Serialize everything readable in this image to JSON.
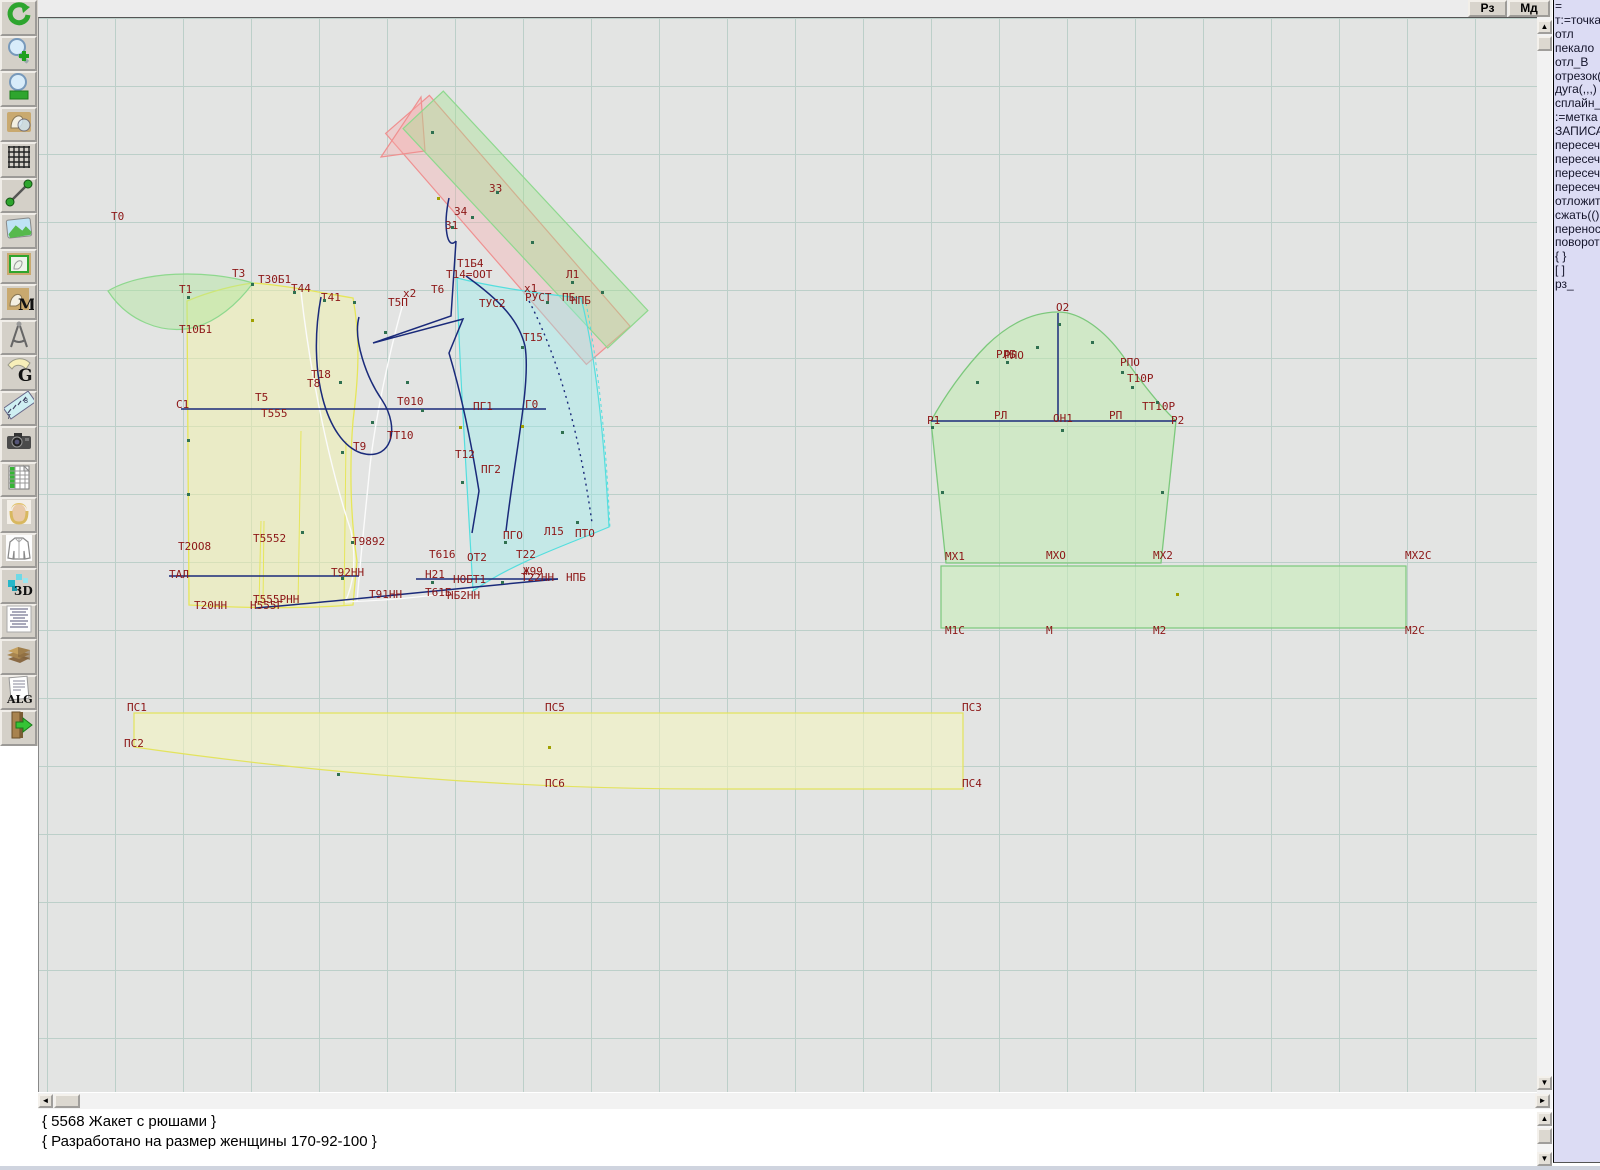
{
  "topbar": {
    "buttons": [
      {
        "label": "Рз"
      },
      {
        "label": "Мд"
      }
    ]
  },
  "toolbar": {
    "items": [
      "refresh",
      "zoom-in",
      "zoom-out",
      "preview-pattern",
      "grid-toggle",
      "segment-tool",
      "image-view",
      "pattern-frame",
      "pattern-marker",
      "compass-tool",
      "grading",
      "ruler-tool",
      "camera-snapshot",
      "size-table",
      "model-photo",
      "garment-view",
      "view-3d",
      "specification",
      "archive",
      "algorithm",
      "exit"
    ]
  },
  "command_panel": {
    "lines": [
      "=",
      "т:=точка",
      "отл",
      "пекало",
      "отл_В",
      "отрезок(",
      "дуга(,,,)",
      "сплайн_",
      ":=метка",
      "ЗАПИСА",
      "пересеч",
      "пересеч",
      "пересеч",
      "пересеч",
      "отложит",
      "сжать(()",
      "перенос",
      "поворот",
      "{ }",
      "[ ]",
      "рз_"
    ]
  },
  "status": {
    "line1": "{ 5568 Жакет с рюшами }",
    "line2": "{ Разработано на размер женщины 170-92-100 }"
  },
  "colors": {
    "canvas_bg": "#e3e4e3",
    "grid_line": "#bccfc9",
    "label": "#8c1616",
    "construction": "#1a2a7a",
    "back_piece": "#e6e65a",
    "front_piece": "#54dede",
    "sleeve_piece": "#7cc87c",
    "strip_green": "#8ed88e",
    "strip_pink": "#ef9090",
    "point_green": "#2f7050",
    "point_olive": "#a0a000",
    "panel_bg": "#dcdcf4"
  },
  "canvas": {
    "labels": [
      {
        "t": "Т0",
        "x": 110,
        "y": 210
      },
      {
        "t": "Т1",
        "x": 178,
        "y": 283
      },
      {
        "t": "Т3",
        "x": 231,
        "y": 267
      },
      {
        "t": "Т30Б1",
        "x": 257,
        "y": 273
      },
      {
        "t": "Т44",
        "x": 290,
        "y": 282
      },
      {
        "t": "Т41",
        "x": 320,
        "y": 291
      },
      {
        "t": "Т10Б1",
        "x": 178,
        "y": 323
      },
      {
        "t": "Т18",
        "x": 310,
        "y": 368
      },
      {
        "t": "Т8",
        "x": 306,
        "y": 377
      },
      {
        "t": "Т5",
        "x": 254,
        "y": 391
      },
      {
        "t": "С1",
        "x": 175,
        "y": 398
      },
      {
        "t": "Т555",
        "x": 260,
        "y": 407
      },
      {
        "t": "Т010",
        "x": 396,
        "y": 395
      },
      {
        "t": "ПГ1",
        "x": 472,
        "y": 400
      },
      {
        "t": "Г0",
        "x": 524,
        "y": 398
      },
      {
        "t": "ТТ10",
        "x": 386,
        "y": 429
      },
      {
        "t": "Т9",
        "x": 352,
        "y": 440
      },
      {
        "t": "Т12",
        "x": 454,
        "y": 448
      },
      {
        "t": "ПГ2",
        "x": 480,
        "y": 463
      },
      {
        "t": "Т15",
        "x": 522,
        "y": 331
      },
      {
        "t": "х2",
        "x": 402,
        "y": 287
      },
      {
        "t": "Т5П",
        "x": 387,
        "y": 296
      },
      {
        "t": "Т6",
        "x": 430,
        "y": 283
      },
      {
        "t": "Т1Б4",
        "x": 456,
        "y": 257
      },
      {
        "t": "Т14=ООТ",
        "x": 445,
        "y": 268
      },
      {
        "t": "х1",
        "x": 523,
        "y": 282
      },
      {
        "t": "Л1",
        "x": 565,
        "y": 268
      },
      {
        "t": "ТУС2",
        "x": 478,
        "y": 297
      },
      {
        "t": "РУСТ",
        "x": 524,
        "y": 291
      },
      {
        "t": "ПБ",
        "x": 561,
        "y": 291
      },
      {
        "t": "НПБ",
        "x": 570,
        "y": 294
      },
      {
        "t": "З3",
        "x": 488,
        "y": 182
      },
      {
        "t": "З4",
        "x": 453,
        "y": 205
      },
      {
        "t": "З1",
        "x": 444,
        "y": 219
      },
      {
        "t": "Т2ОО8",
        "x": 177,
        "y": 540
      },
      {
        "t": "Т5552",
        "x": 252,
        "y": 532
      },
      {
        "t": "Т9892",
        "x": 351,
        "y": 535
      },
      {
        "t": "ТАЛ",
        "x": 168,
        "y": 568
      },
      {
        "t": "Т92НН",
        "x": 330,
        "y": 566
      },
      {
        "t": "Т91НН",
        "x": 368,
        "y": 588
      },
      {
        "t": "Т616",
        "x": 428,
        "y": 548
      },
      {
        "t": "ОТ2",
        "x": 466,
        "y": 551
      },
      {
        "t": "Т22",
        "x": 515,
        "y": 548
      },
      {
        "t": "Н21",
        "x": 424,
        "y": 568
      },
      {
        "t": "НОБТ1",
        "x": 452,
        "y": 573
      },
      {
        "t": "Ж99",
        "x": 522,
        "y": 565
      },
      {
        "t": "Т22НН",
        "x": 520,
        "y": 571
      },
      {
        "t": "НПБ",
        "x": 565,
        "y": 571
      },
      {
        "t": "Т61Б",
        "x": 424,
        "y": 586
      },
      {
        "t": "НБ2НН",
        "x": 446,
        "y": 589
      },
      {
        "t": "Т20НН",
        "x": 193,
        "y": 599
      },
      {
        "t": "Т555РНН",
        "x": 252,
        "y": 593
      },
      {
        "t": "Н555Г",
        "x": 249,
        "y": 599
      },
      {
        "t": "ПГО",
        "x": 502,
        "y": 529
      },
      {
        "t": "Л15",
        "x": 543,
        "y": 525
      },
      {
        "t": "ПТО",
        "x": 574,
        "y": 527
      },
      {
        "t": "О2",
        "x": 1055,
        "y": 301
      },
      {
        "t": "РЛБ",
        "x": 995,
        "y": 348
      },
      {
        "t": "РЛО",
        "x": 1003,
        "y": 349
      },
      {
        "t": "РПО",
        "x": 1119,
        "y": 356
      },
      {
        "t": "Т10Р",
        "x": 1126,
        "y": 372
      },
      {
        "t": "ТТ10Р",
        "x": 1141,
        "y": 400
      },
      {
        "t": "Р1",
        "x": 926,
        "y": 414
      },
      {
        "t": "РЛ",
        "x": 993,
        "y": 409
      },
      {
        "t": "ОН1",
        "x": 1052,
        "y": 412
      },
      {
        "t": "РП",
        "x": 1108,
        "y": 409
      },
      {
        "t": "Р2",
        "x": 1170,
        "y": 414
      },
      {
        "t": "МХ1",
        "x": 944,
        "y": 550
      },
      {
        "t": "МХО",
        "x": 1045,
        "y": 549
      },
      {
        "t": "МХ2",
        "x": 1152,
        "y": 549
      },
      {
        "t": "МХ2С",
        "x": 1404,
        "y": 549
      },
      {
        "t": "М1С",
        "x": 944,
        "y": 624
      },
      {
        "t": "М",
        "x": 1045,
        "y": 624
      },
      {
        "t": "М2",
        "x": 1152,
        "y": 624
      },
      {
        "t": "М2С",
        "x": 1404,
        "y": 624
      },
      {
        "t": "ПС1",
        "x": 126,
        "y": 701
      },
      {
        "t": "ПС2",
        "x": 123,
        "y": 737
      },
      {
        "t": "ПС5",
        "x": 544,
        "y": 701
      },
      {
        "t": "ПС6",
        "x": 544,
        "y": 777
      },
      {
        "t": "ПС3",
        "x": 961,
        "y": 701
      },
      {
        "t": "ПС4",
        "x": 961,
        "y": 777
      }
    ],
    "points": [
      [
        186,
        295,
        "g"
      ],
      [
        186,
        438,
        "g"
      ],
      [
        186,
        492,
        "g"
      ],
      [
        250,
        282,
        "g"
      ],
      [
        292,
        290,
        "g"
      ],
      [
        322,
        298,
        "g"
      ],
      [
        352,
        300,
        "g"
      ],
      [
        338,
        380,
        "g"
      ],
      [
        250,
        318,
        "o"
      ],
      [
        340,
        450,
        "g"
      ],
      [
        300,
        530,
        "g"
      ],
      [
        350,
        540,
        "g"
      ],
      [
        420,
        408,
        "g"
      ],
      [
        458,
        425,
        "o"
      ],
      [
        520,
        424,
        "o"
      ],
      [
        460,
        480,
        "g"
      ],
      [
        503,
        540,
        "g"
      ],
      [
        340,
        576,
        "g"
      ],
      [
        430,
        580,
        "g"
      ],
      [
        500,
        580,
        "g"
      ],
      [
        545,
        300,
        "g"
      ],
      [
        520,
        345,
        "g"
      ],
      [
        560,
        430,
        "g"
      ],
      [
        575,
        520,
        "g"
      ],
      [
        450,
        225,
        "g"
      ],
      [
        470,
        215,
        "g"
      ],
      [
        495,
        190,
        "g"
      ],
      [
        430,
        130,
        "g"
      ],
      [
        436,
        196,
        "o"
      ],
      [
        530,
        240,
        "g"
      ],
      [
        570,
        280,
        "g"
      ],
      [
        600,
        290,
        "g"
      ],
      [
        940,
        490,
        "g"
      ],
      [
        1057,
        322,
        "g"
      ],
      [
        1035,
        345,
        "g"
      ],
      [
        1090,
        340,
        "g"
      ],
      [
        975,
        380,
        "g"
      ],
      [
        1130,
        385,
        "g"
      ],
      [
        1155,
        400,
        "g"
      ],
      [
        930,
        425,
        "g"
      ],
      [
        1060,
        428,
        "g"
      ],
      [
        1160,
        490,
        "g"
      ],
      [
        1175,
        592,
        "o"
      ],
      [
        547,
        745,
        "o"
      ],
      [
        336,
        772,
        "g"
      ],
      [
        1005,
        360,
        "g"
      ],
      [
        1120,
        370,
        "g"
      ],
      [
        383,
        330,
        "g"
      ],
      [
        405,
        380,
        "g"
      ],
      [
        370,
        420,
        "g"
      ]
    ]
  }
}
